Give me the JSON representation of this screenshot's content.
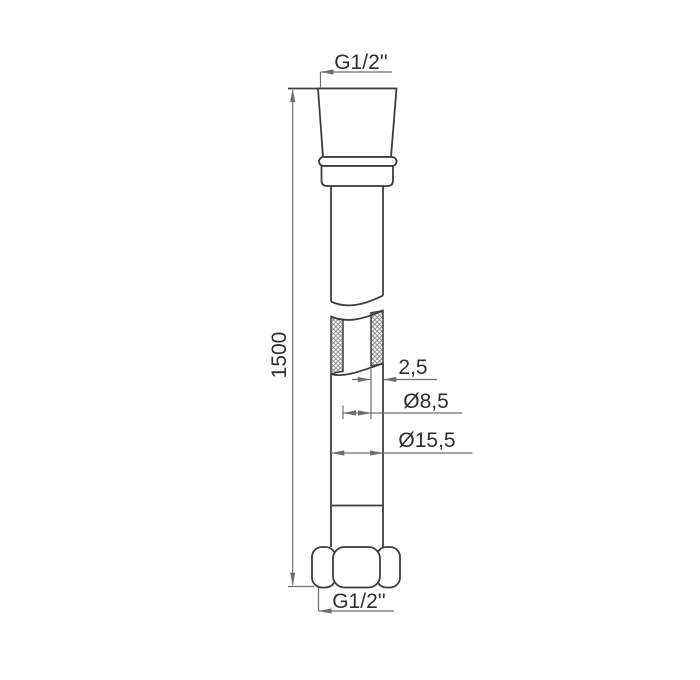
{
  "drawing": {
    "title": "shower-hose-technical-drawing",
    "labels": {
      "thread_top": "G1/2''",
      "length": "1500",
      "wall_thickness": "2,5",
      "inner_diameter": "Ø8,5",
      "outer_diameter": "Ø15,5",
      "thread_bottom": "G1/2''"
    },
    "colors": {
      "background": "#ffffff",
      "object_line": "#3d3d3d",
      "dimension_line": "#6e6e6e",
      "hatch_line": "#8a8a8a",
      "text": "#2e2e2e"
    }
  }
}
